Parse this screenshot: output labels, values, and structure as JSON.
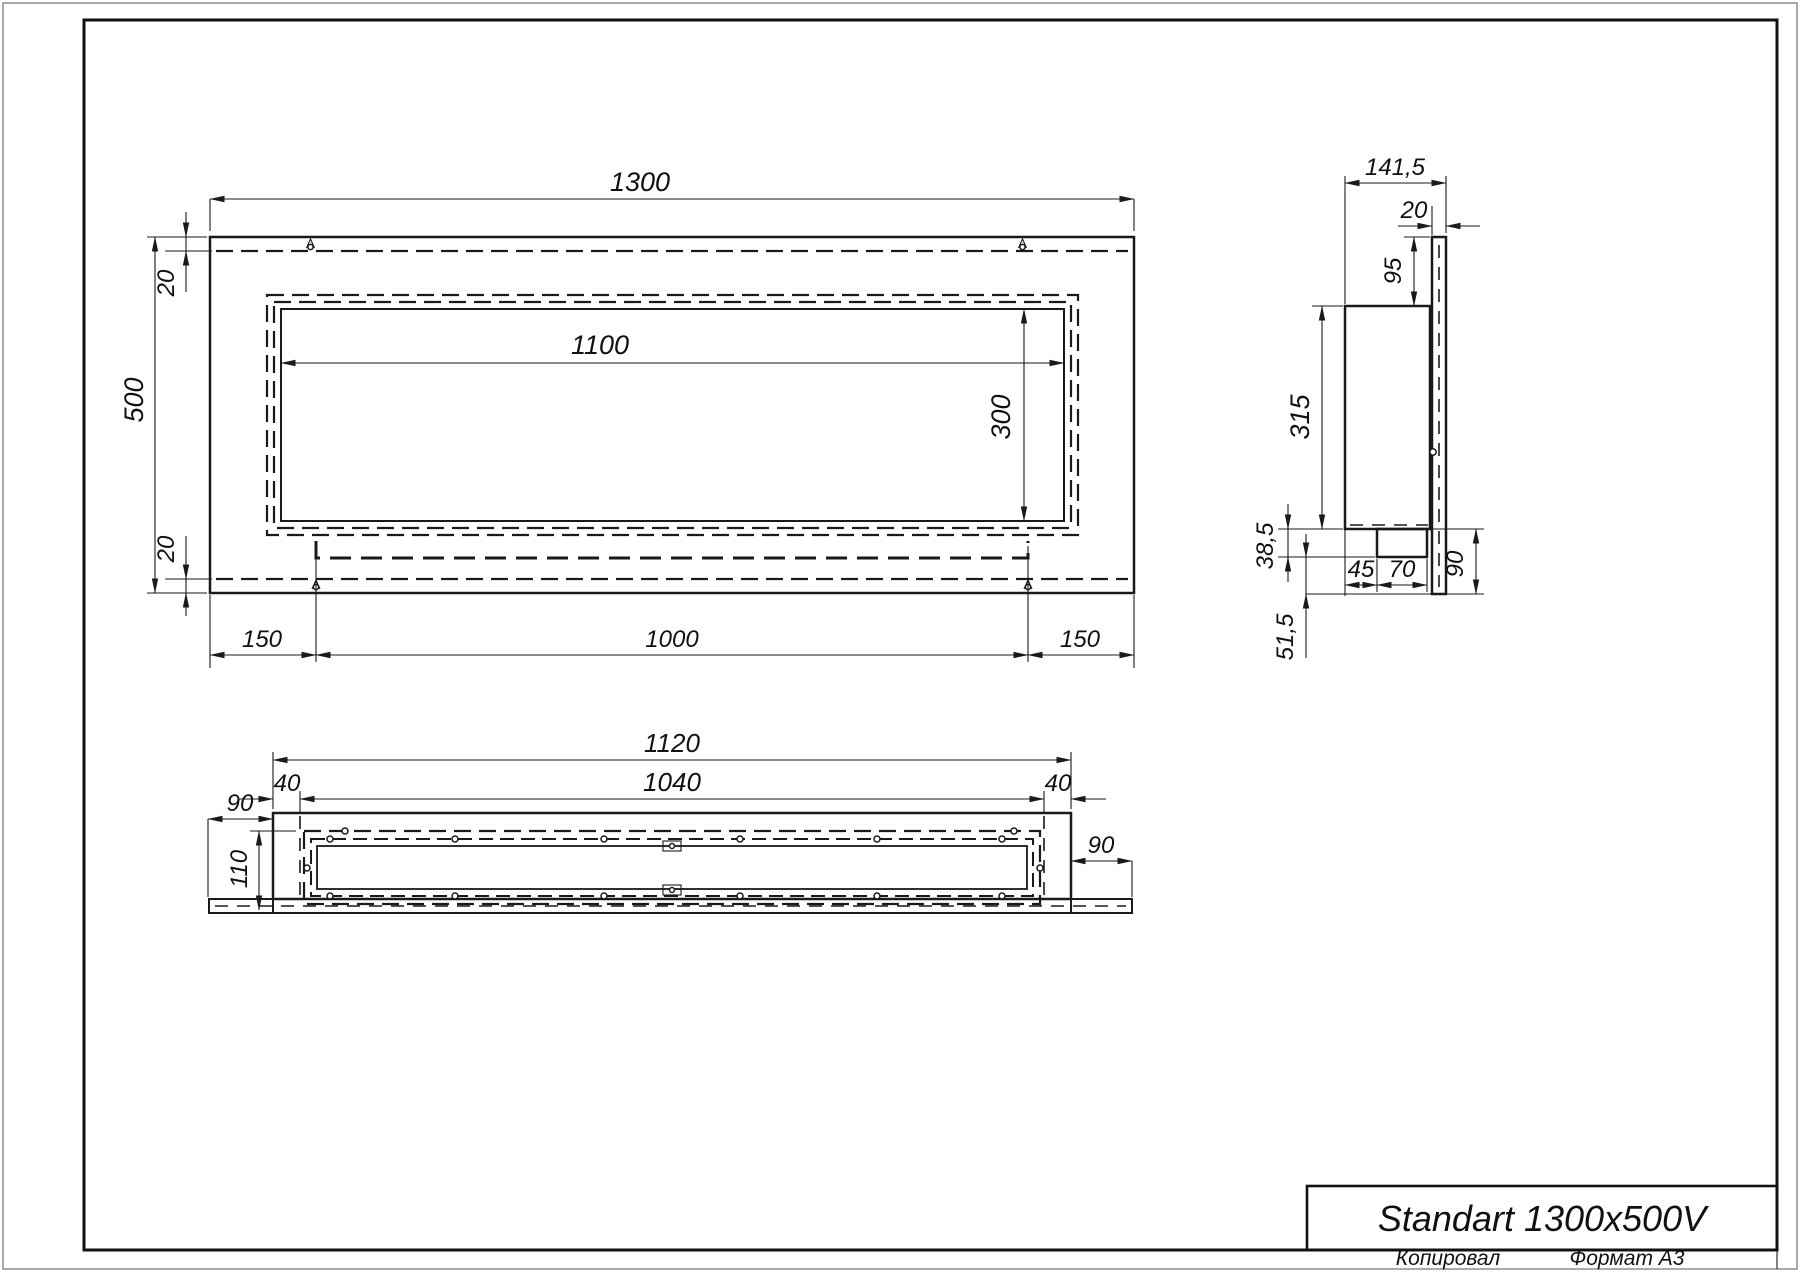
{
  "sheet": {
    "copied_label": "Копировал",
    "format_label": "Формат А3"
  },
  "title_block": {
    "title": "Standart 1300x500V"
  },
  "front_view": {
    "width_total": "1300",
    "height_total": "500",
    "top_flange": "20",
    "bottom_flange": "20",
    "opening_width": "1100",
    "opening_height": "300",
    "left_inset": "150",
    "tray_width": "1000",
    "right_inset": "150"
  },
  "side_view": {
    "depth_total": "141,5",
    "flange_thickness": "20",
    "top_offset": "95",
    "body_height": "315",
    "tray_drop": "38,5",
    "lower_offset": "51,5",
    "notch_offset": "45",
    "notch_width": "70",
    "bottom_height": "90"
  },
  "bottom_view": {
    "body_width": "1120",
    "inner_width": "1040",
    "left_plate": "40",
    "right_plate": "40",
    "left_overhang": "90",
    "right_overhang": "90",
    "tray_depth": "110"
  }
}
